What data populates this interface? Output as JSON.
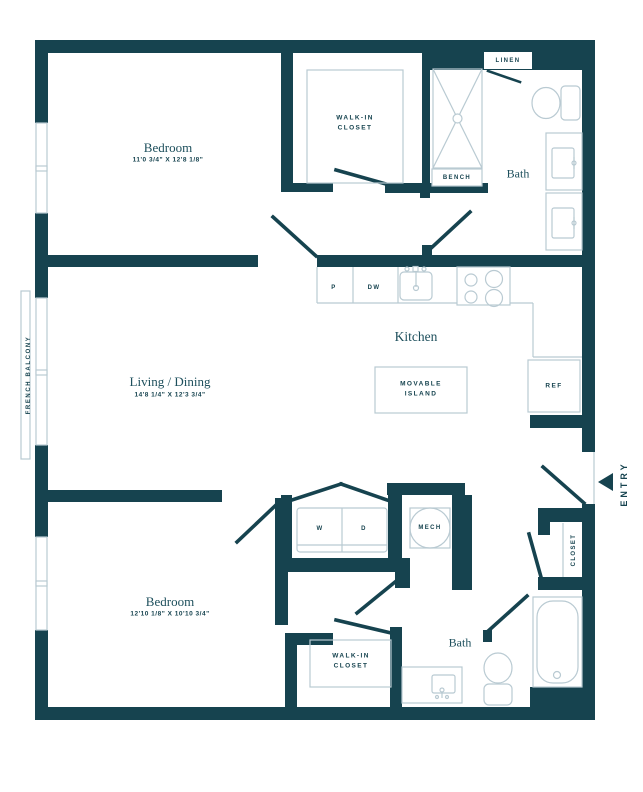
{
  "floorplan": {
    "colors": {
      "wall": "#16434f",
      "fixture_line": "#b9cad2",
      "text": "#1d4f5c"
    },
    "rooms": {
      "bedroom_top": {
        "name": "Bedroom",
        "dims": "11'0 3/4\" X 12'8 1/8\""
      },
      "living_dining": {
        "name": "Living / Dining",
        "dims": "14'8 1/4\" X 12'3 3/4\""
      },
      "kitchen": {
        "name": "Kitchen"
      },
      "bath_top": {
        "name": "Bath"
      },
      "bedroom_bottom": {
        "name": "Bedroom",
        "dims": "12'10 1/8\" X 10'10 3/4\""
      },
      "bath_bottom": {
        "name": "Bath"
      }
    },
    "labels": {
      "walk_in_closet_top": "WALK-IN\nCLOSET",
      "walk_in_closet_bottom": "WALK-IN\nCLOSET",
      "linen": "LINEN",
      "bench": "BENCH",
      "movable_island": "MOVABLE\nISLAND",
      "ref": "REF",
      "pantry": "P",
      "dishwasher": "DW",
      "washer": "W",
      "dryer": "D",
      "mech": "MECH",
      "closet": "CLOSET",
      "entry": "ENTRY",
      "french_balcony": "FRENCH BALCONY"
    }
  }
}
